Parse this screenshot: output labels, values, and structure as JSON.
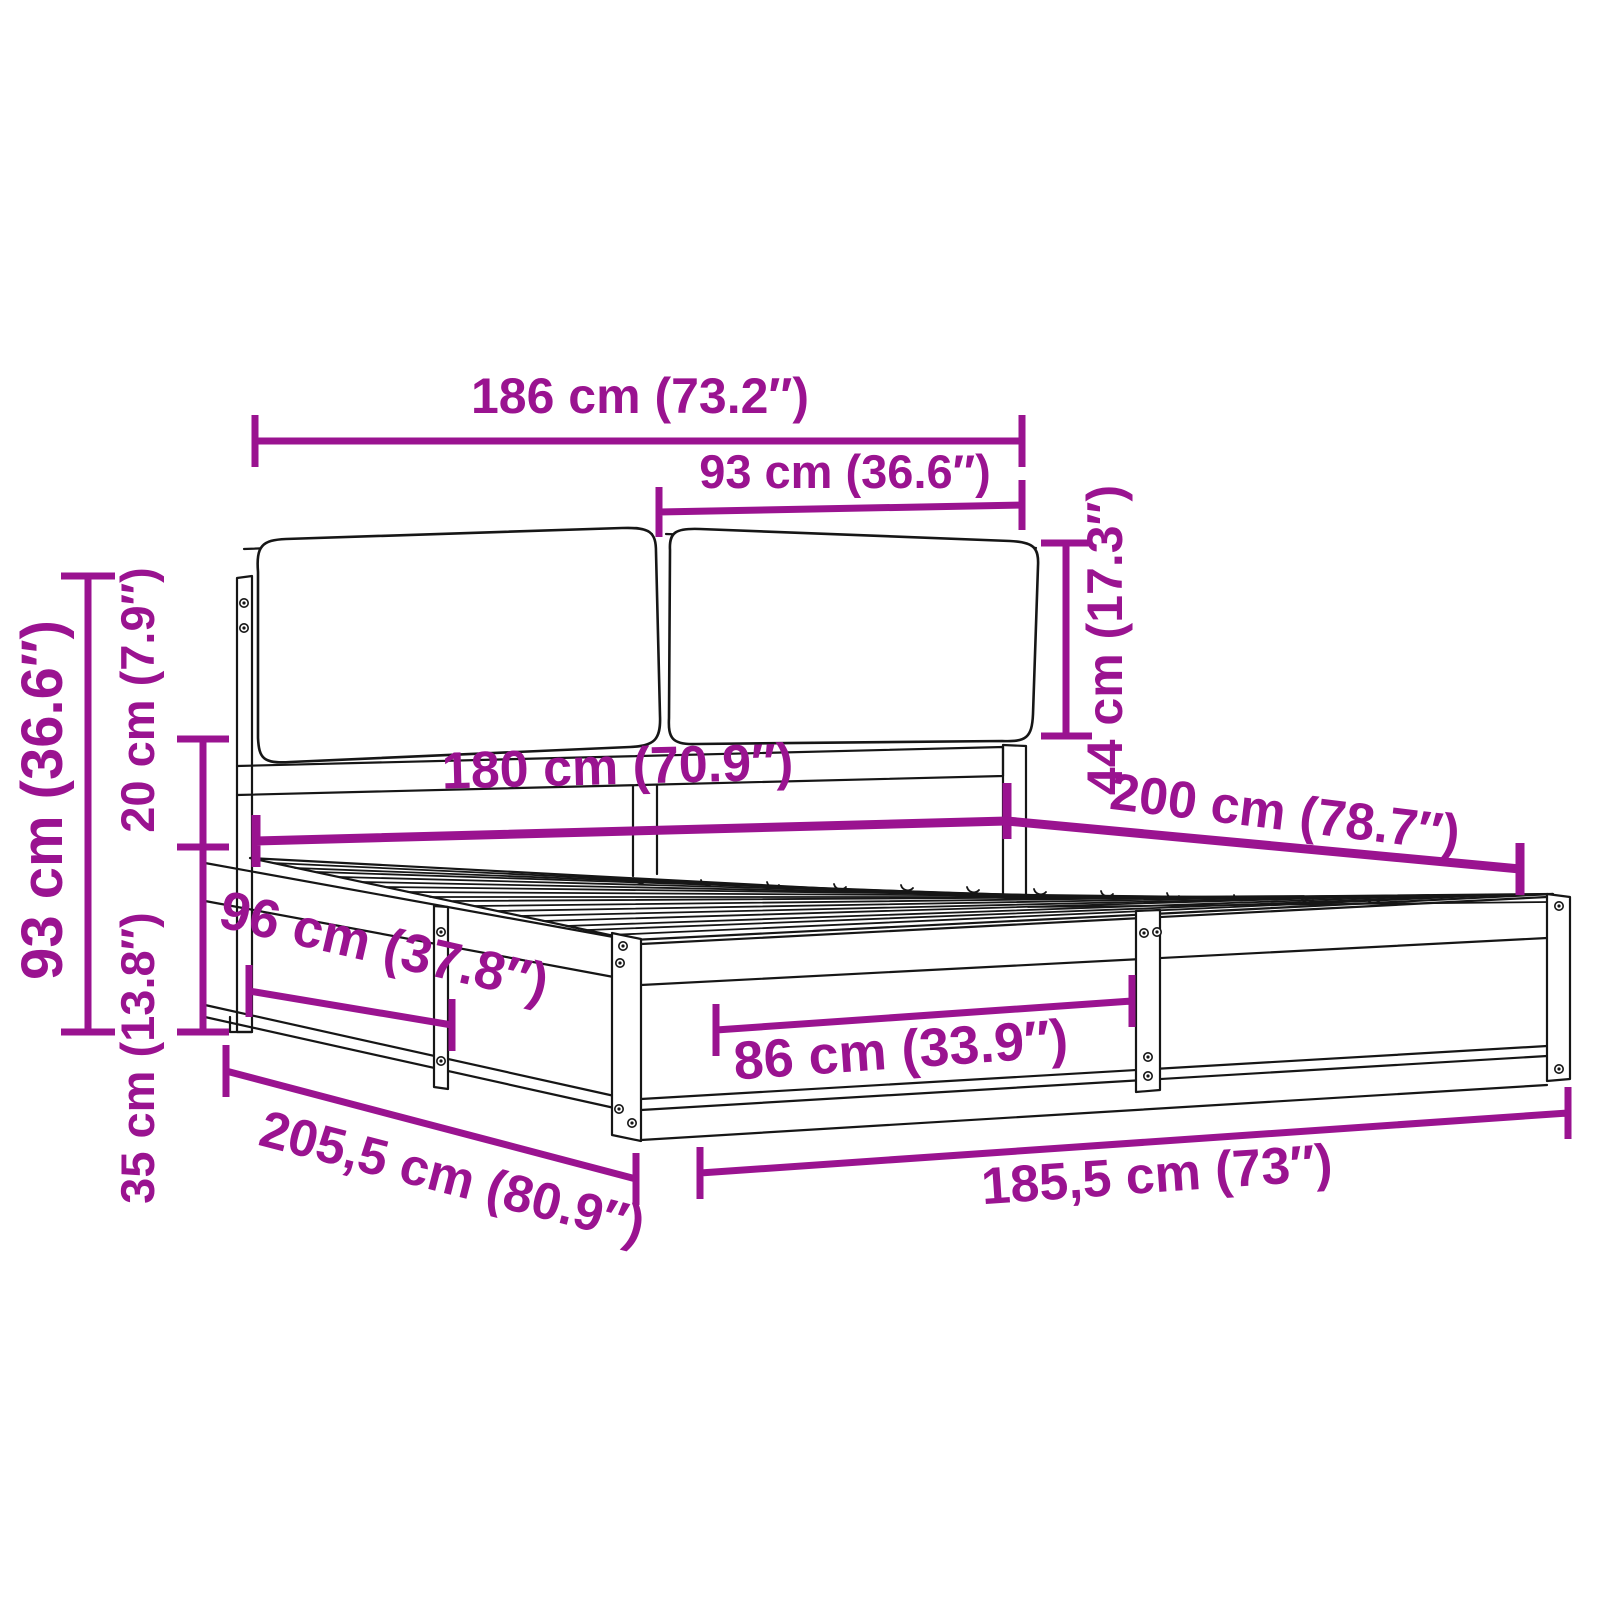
{
  "canvas": {
    "width": 1600,
    "height": 1600,
    "background": "#ffffff"
  },
  "colors": {
    "dimension_accent": "#9a1390",
    "line_art": "#161616"
  },
  "diagram": {
    "kind": "product-dimension-diagram",
    "subject": "bed frame with slatted base and two headboard cushions",
    "units": "cm and inches",
    "dimensions": [
      {
        "id": "headboard-total-width",
        "label": "186 cm (73.2″)",
        "cm": "186",
        "inches": "73.2"
      },
      {
        "id": "cushion-width",
        "label": "93 cm (36.6″)",
        "cm": "93",
        "inches": "36.6"
      },
      {
        "id": "cushion-height",
        "label": "44 cm (17.3″)",
        "cm": "44",
        "inches": "17.3"
      },
      {
        "id": "headboard-height",
        "label": "93 cm (36.6″)",
        "cm": "93",
        "inches": "36.6"
      },
      {
        "id": "rail-to-cushion-gap",
        "label": "20 cm (7.9″)",
        "cm": "20",
        "inches": "7.9"
      },
      {
        "id": "base-height",
        "label": "35 cm (13.8″)",
        "cm": "35",
        "inches": "13.8"
      },
      {
        "id": "inner-width",
        "label": "180 cm (70.9″)",
        "cm": "180",
        "inches": "70.9"
      },
      {
        "id": "inner-length",
        "label": "200 cm (78.7″)",
        "cm": "200",
        "inches": "78.7"
      },
      {
        "id": "side-section-length",
        "label": "96 cm (37.8″)",
        "cm": "96",
        "inches": "37.8"
      },
      {
        "id": "front-section-width",
        "label": "86 cm (33.9″)",
        "cm": "86",
        "inches": "33.9"
      },
      {
        "id": "total-length",
        "label": "205,5 cm (80.9″)",
        "cm": "205,5",
        "inches": "80.9"
      },
      {
        "id": "total-width",
        "label": "185,5 cm (73″)",
        "cm": "185,5",
        "inches": "73"
      }
    ]
  }
}
